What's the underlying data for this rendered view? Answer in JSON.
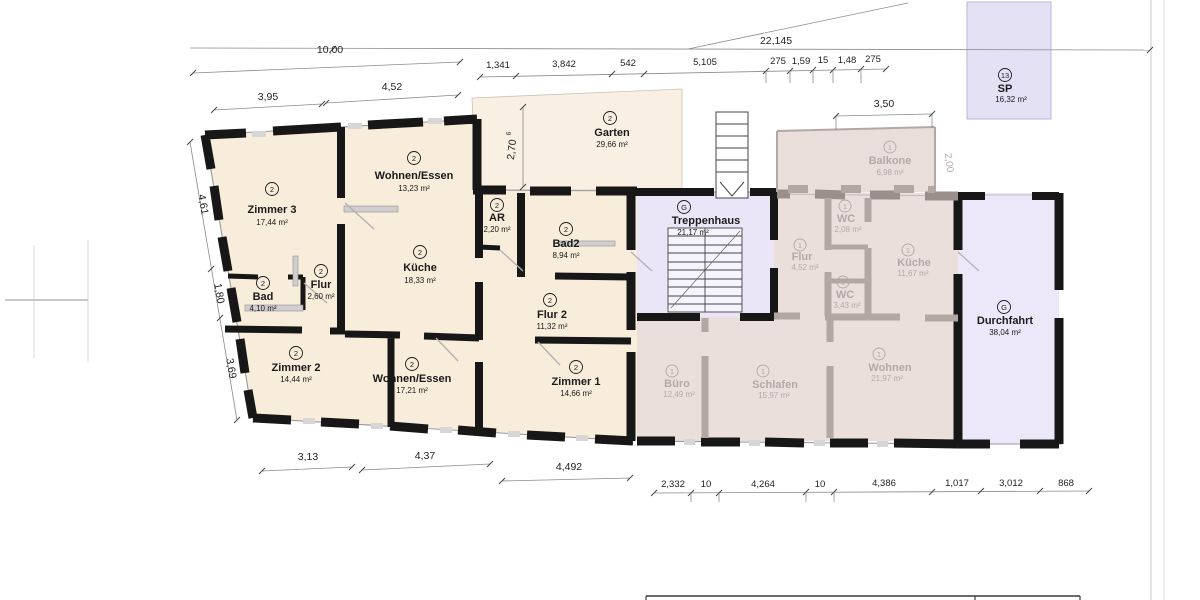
{
  "plan": {
    "rooms": {
      "zimmer3": {
        "id": "2",
        "name": "Zimmer 3",
        "area": "17,44 m²"
      },
      "wohnen_essen_a": {
        "id": "2",
        "name": "Wohnen/Essen",
        "area": "13,23 m²"
      },
      "kueche_eg": {
        "id": "2",
        "name": "Küche",
        "area": "18,33 m²"
      },
      "bad": {
        "id": "2",
        "name": "Bad",
        "area": "4,10 m²"
      },
      "flur_eg": {
        "id": "2",
        "name": "Flur",
        "area": "2,60 m²"
      },
      "zimmer2": {
        "id": "2",
        "name": "Zimmer 2",
        "area": "14,44 m²"
      },
      "wohnen_essen_b": {
        "id": "2",
        "name": "Wohnen/Essen",
        "area": "17,21 m²"
      },
      "ar": {
        "id": "2",
        "name": "AR",
        "area": "2,20 m²"
      },
      "bad2": {
        "id": "2",
        "name": "Bad2",
        "area": "8,94 m²"
      },
      "flur2": {
        "id": "2",
        "name": "Flur 2",
        "area": "11,32 m²"
      },
      "zimmer1": {
        "id": "2",
        "name": "Zimmer 1",
        "area": "14,66 m²"
      },
      "garten": {
        "id": "2",
        "name": "Garten",
        "area": "29,66 m²"
      },
      "treppenhaus": {
        "id": "G",
        "name": "Treppenhaus",
        "area": "21,17 m²"
      },
      "durchfahrt": {
        "id": "G",
        "name": "Durchfahrt",
        "area": "38,04 m²"
      },
      "sp": {
        "id": "13",
        "name": "SP",
        "area": "16,32 m²"
      },
      "balkone": {
        "id": "1",
        "name": "Balkone",
        "area": "6,98 m²"
      },
      "wc_og": {
        "id": "1",
        "name": "WC",
        "area": "2,08 m²"
      },
      "flur_og": {
        "id": "1",
        "name": "Flur",
        "area": "4,52 m²"
      },
      "kueche_og": {
        "id": "1",
        "name": "Küche",
        "area": "11,67 m²"
      },
      "wc2_og": {
        "id": "1",
        "name": "WC",
        "area": "3,43 m²"
      },
      "buero": {
        "id": "1",
        "name": "Büro",
        "area": "12,49 m²"
      },
      "schlafen": {
        "id": "1",
        "name": "Schlafen",
        "area": "15,97 m²"
      },
      "wohnen_og": {
        "id": "1",
        "name": "Wohnen",
        "area": "21,97 m²"
      }
    },
    "dimensions": {
      "total_width": "22,145",
      "left_width": "10,00",
      "top_left": [
        "3,95",
        "4,52"
      ],
      "top_right": [
        "1,341",
        "3,842",
        "542",
        "5,105",
        "275",
        "1,59",
        "15",
        "1,48",
        "275"
      ],
      "balcony_width": "3,50",
      "balcony_depth": "2,00",
      "garden_depth": "2,70",
      "garden_depth_sup": "6",
      "left_side": [
        "4,61",
        "1,80",
        "3,69"
      ],
      "bottom_left": [
        "3,13",
        "4,37",
        "4,492"
      ],
      "bottom_right": [
        "2,332",
        "10",
        "4,264",
        "10",
        "4,386",
        "1,017",
        "3,012",
        "868"
      ]
    },
    "colors": {
      "flat_fill": "#f8ecdb",
      "garden_fill": "#f9efe2",
      "stair_fill": "#eae6f8",
      "passage_fill": "#ece8f9",
      "overlay_fill": "#ebdfdb",
      "wall": "#171717",
      "faded_wall": "#b3a7a4"
    }
  }
}
